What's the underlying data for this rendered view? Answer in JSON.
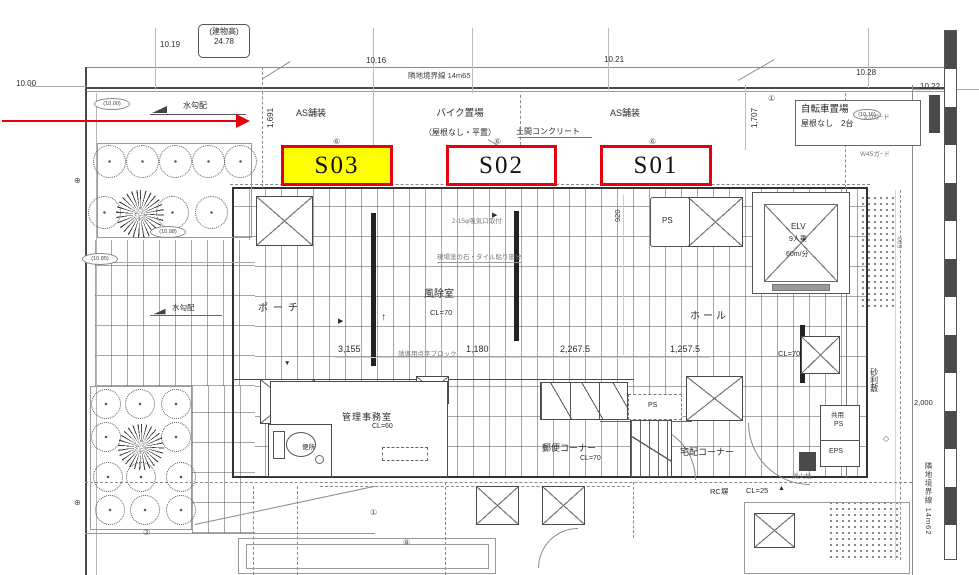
{
  "units": {
    "s03": "S03",
    "s02": "S02",
    "s01": "S01"
  },
  "colors": {
    "highlight": "#ffff00",
    "annotation_red": "#e8000d"
  },
  "boundary": {
    "top": "隣地境界線 14m65",
    "right": "隣地境界線 14m62"
  },
  "elevations": {
    "left": "10.00",
    "v1": "10.19",
    "v2": "10.16",
    "v3": "10.21",
    "v4": "10.28",
    "right": "10.22"
  },
  "callout": {
    "l1": "(建物高)",
    "l2": "24.78"
  },
  "spot_levels": {
    "p1": "(10.00)",
    "p2": "(10.98)",
    "p3": "(10.85)",
    "p4": "(10.16)"
  },
  "site": {
    "bike1": "バイク置場",
    "bike2": "（屋根なし・平置）",
    "as1": "AS舗装",
    "as2": "AS舗装",
    "doma": "土間コンクリート",
    "cycle1": "自転車置場",
    "cycle2": "屋根なし　2台",
    "slope1": "水勾配",
    "slope2": "水勾配",
    "gravel": "砂利敷",
    "rc_wall": "RC塀"
  },
  "rooms": {
    "porch": "ポーチ",
    "vestibule": "風除室",
    "hall": "ホール",
    "office": "管理事務室",
    "toilet": "便所",
    "mail_corner": "郵便コーナー",
    "delivery_corner": "宅配コーナー",
    "ps_top": "PS",
    "ps_mid": "PS",
    "shared_ps1": "共用",
    "shared_ps2": "PS",
    "eps": "EPS",
    "elv1": "ELV",
    "elv2": "9人乗",
    "elv3": "60m/分"
  },
  "dims": {
    "w1": "1,691",
    "w2": "1,707",
    "w3": "3,155",
    "w4": "1,180",
    "w5": "2,267.5",
    "w6": "1,257.5",
    "w7": "920",
    "w8": "2,000",
    "w9": "500"
  },
  "levels": {
    "cl_vest": "CL=70",
    "cl_office": "CL=60",
    "cl_mail": "CL=70",
    "cl_hall": "CL=70",
    "cl_out": "CL=25"
  },
  "notes": {
    "n1": "2-15φ吸気口取付",
    "n2": "現場塗の石・タイル貼り部分",
    "n3": "誘導用点字ブロック",
    "n4": "9.0ガ−ド",
    "n5": "W45ガ−ド",
    "n6": "消火栓"
  },
  "marks": [
    "⑥",
    "⑥",
    "⑥",
    "①",
    "②",
    "①",
    "⑧",
    "⊕",
    "⊕",
    "◇"
  ]
}
